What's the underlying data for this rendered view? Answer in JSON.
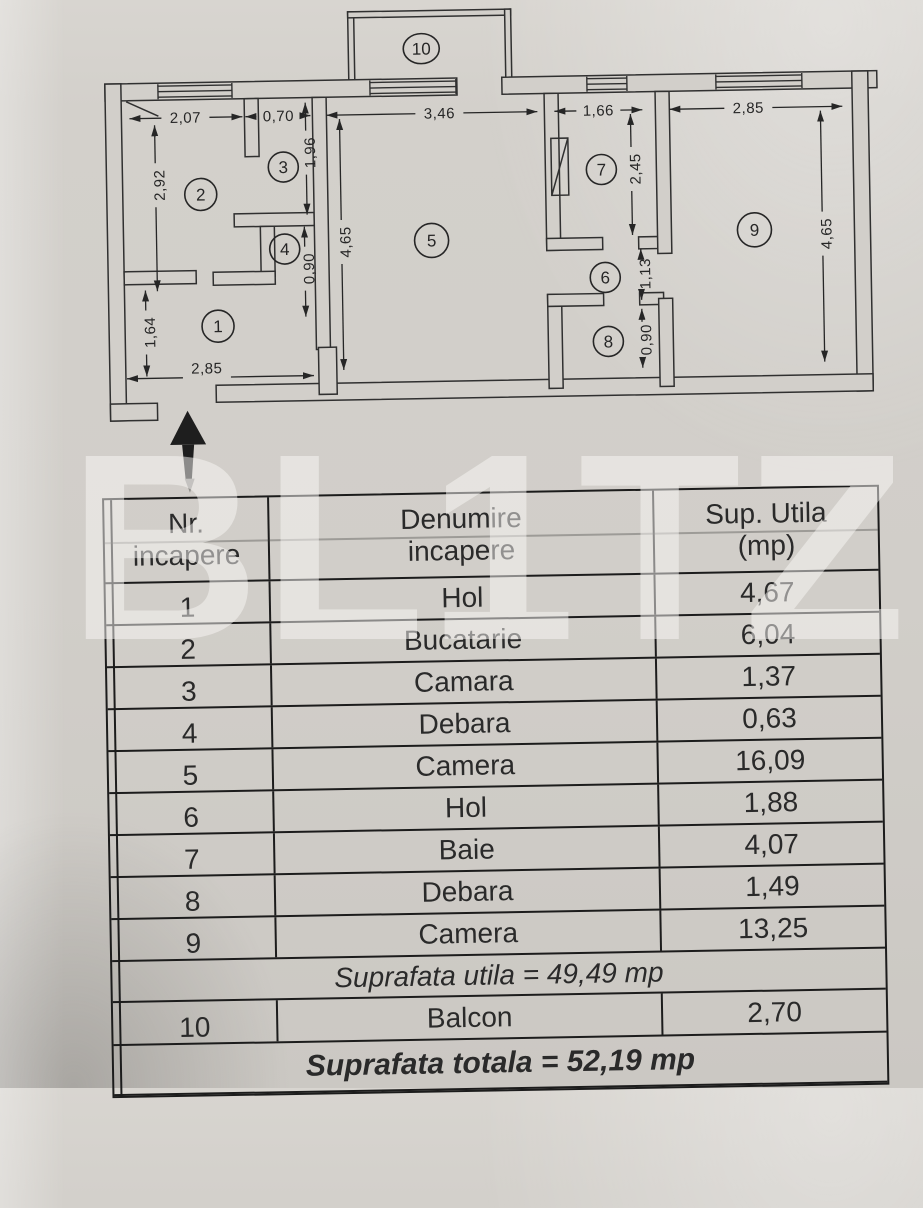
{
  "photo": {
    "paper_color": "#d2cfca",
    "ink_color": "#2a2a2a",
    "table_line_color": "#1c1c1c",
    "watermark_color": "rgba(249,248,246,0.5)"
  },
  "watermark": {
    "letters": [
      "B",
      "L",
      "1",
      "T",
      "Z"
    ]
  },
  "plan": {
    "arrow_icon": "entrance-up-arrow",
    "rooms": [
      "1",
      "2",
      "3",
      "4",
      "5",
      "6",
      "7",
      "8",
      "9",
      "10"
    ],
    "dims": {
      "w_room2": "2,07",
      "w_room3": "0,70",
      "w_room5": "3,46",
      "w_room7": "1,66",
      "w_room9": "2,85",
      "h_room2": "2,92",
      "h_room3": "1,96",
      "h_room4": "0,90",
      "h_room5": "4,65",
      "h_room7": "2,45",
      "h_room6": "1,13",
      "h_room8": "0,90",
      "h_room9": "4,65",
      "h_room1": "1,64",
      "w_room1": "2,85"
    }
  },
  "table": {
    "headers": {
      "nr_line1": "Nr.",
      "nr_line2": "incapere",
      "name_line1": "Denumire",
      "name_line2": "incapere",
      "area_line1": "Sup. Utila",
      "area_line2": "(mp)"
    },
    "rows": [
      {
        "nr": "1",
        "name": "Hol",
        "area": "4,67"
      },
      {
        "nr": "2",
        "name": "Bucatarie",
        "area": "6,04"
      },
      {
        "nr": "3",
        "name": "Camara",
        "area": "1,37"
      },
      {
        "nr": "4",
        "name": "Debara",
        "area": "0,63"
      },
      {
        "nr": "5",
        "name": "Camera",
        "area": "16,09"
      },
      {
        "nr": "6",
        "name": "Hol",
        "area": "1,88"
      },
      {
        "nr": "7",
        "name": "Baie",
        "area": "4,07"
      },
      {
        "nr": "8",
        "name": "Debara",
        "area": "1,49"
      },
      {
        "nr": "9",
        "name": "Camera",
        "area": "13,25"
      },
      {
        "nr": "10",
        "name": "Balcon",
        "area": "2,70"
      }
    ],
    "summary_utila": "Suprafata utila = 49,49 mp",
    "summary_totala": "Suprafata totala = 52,19 mp"
  }
}
